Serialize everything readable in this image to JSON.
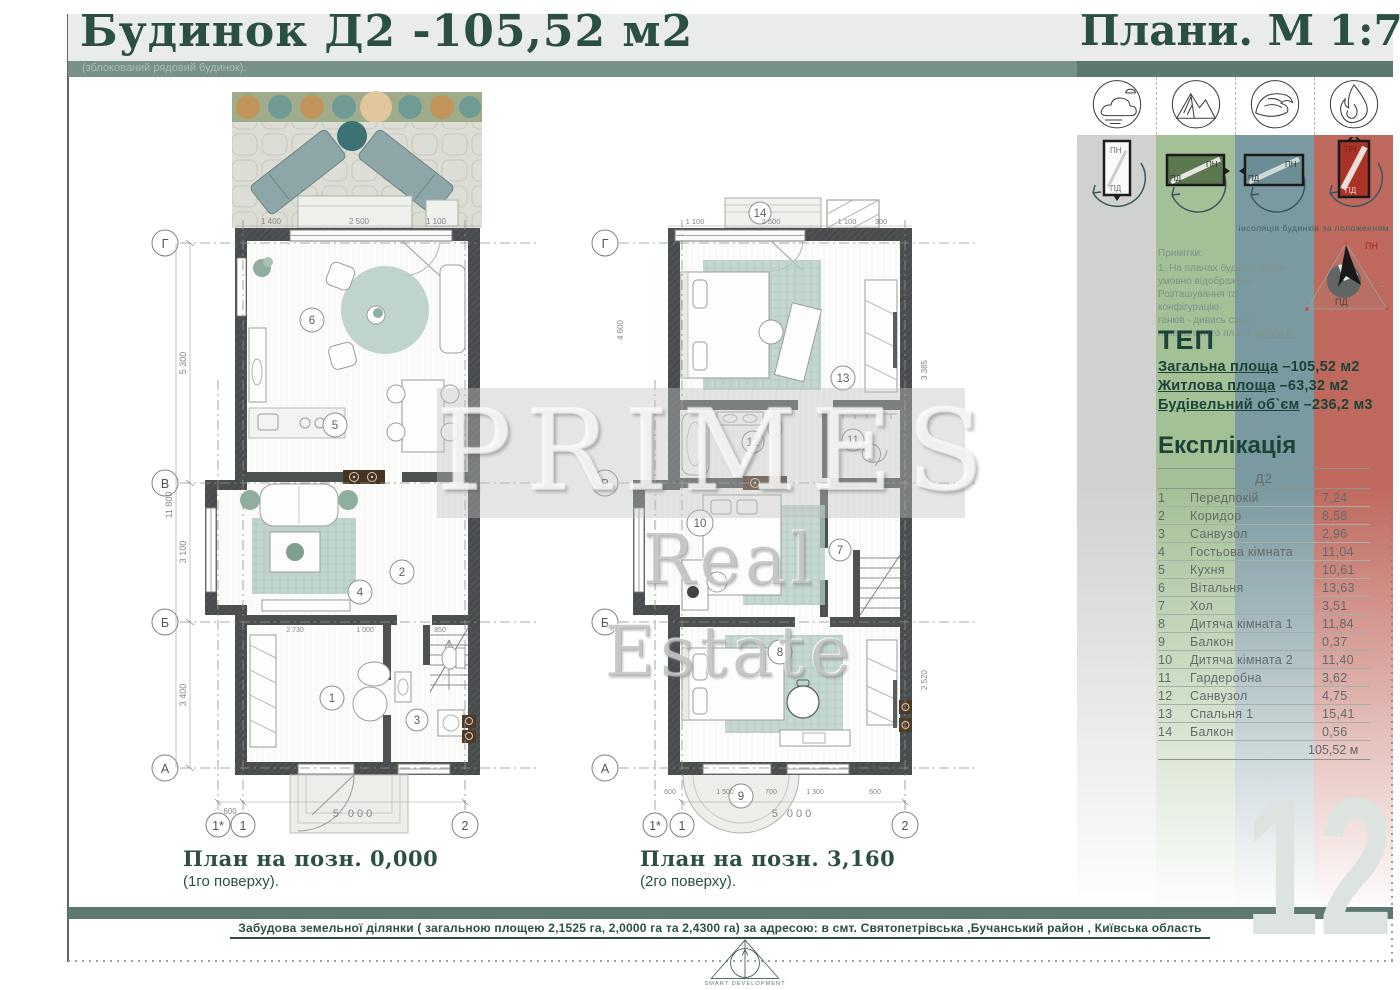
{
  "header": {
    "title": "Будинок Д2 -105,52 м2",
    "subtitle": "(зблокований рядовий будинок).",
    "scale_label": "Плани. М 1:75"
  },
  "watermark": {
    "brand": "PRIMES",
    "brand_sub": "Real Estate"
  },
  "sidebar": {
    "element_icons": [
      "air-icon",
      "mountains-icon",
      "water-icon",
      "fire-icon"
    ],
    "window_north": "ПН",
    "window_south": "ПД",
    "insolation_caption": "інсоляція будинків за положенням",
    "compass": {
      "north": "ПН",
      "south": "ПД",
      "west": "З",
      "east": "С"
    },
    "notes": {
      "title": "Примітки:",
      "lines": [
        "1. На планах будинку ганки",
        "умовно відображені.",
        "Розташування та конфігурацію",
        "ганків - дивись схему",
        "генерального плану, "
      ],
      "link": "аркуш 5."
    },
    "tep": {
      "title": "ТЕП",
      "items": [
        {
          "label": "Загальна площа",
          "value": " –105,52 м2"
        },
        {
          "label": "Житлова площа",
          "value": " –63,32 м2"
        },
        {
          "label": "Будівельний об`єм",
          "value": "  –236,2 м3"
        }
      ]
    },
    "explication": {
      "title": "Експлікація",
      "column_header": "Д2",
      "rows": [
        {
          "num": "1",
          "name": "Передпокій",
          "area": "7,24"
        },
        {
          "num": "2",
          "name": "Коридор",
          "area": "8,58"
        },
        {
          "num": "3",
          "name": "Санвузол",
          "area": "2,96"
        },
        {
          "num": "4",
          "name": "Гостьова кімната",
          "area": "11,04"
        },
        {
          "num": "5",
          "name": "Кухня",
          "area": "10,61"
        },
        {
          "num": "6",
          "name": "Вітальня",
          "area": "13,63"
        },
        {
          "num": "7",
          "name": "Хол",
          "area": "3,51"
        },
        {
          "num": "8",
          "name": "Дитяча кімната 1",
          "area": "11,84"
        },
        {
          "num": "9",
          "name": "Балкон",
          "area": "0,37"
        },
        {
          "num": "10",
          "name": "Дитяча кімната 2",
          "area": "11,40"
        },
        {
          "num": "11",
          "name": "Гардеробна",
          "area": "3,62"
        },
        {
          "num": "12",
          "name": "Санвузол",
          "area": "4,75"
        },
        {
          "num": "13",
          "name": "Спальня 1",
          "area": "15,41"
        },
        {
          "num": "14",
          "name": "Балкон",
          "area": "0,56"
        }
      ],
      "total": "105,52 м"
    },
    "page_number": "12"
  },
  "plans": {
    "left": {
      "caption": "План на позн. 0,000",
      "caption_sub": "(1го поверху).",
      "axis_rows": [
        "Г",
        "В",
        "Б",
        "А"
      ],
      "axis_cols": [
        "1*",
        "1",
        "2"
      ],
      "rooms": {
        "r1": "1",
        "r2": "2",
        "r3": "3",
        "r4": "4",
        "r5": "5",
        "r6": "6"
      },
      "dims": {
        "top_left": "1 400",
        "top_center": "2 500",
        "top_right": "1 100",
        "v_total": "11 800",
        "v1": "5 300",
        "v2": "3 100",
        "v3": "3 400",
        "bottom_small": "600",
        "bottom_total": "5 000",
        "inner1": "2 730",
        "inner2": "1 000",
        "inner3": "850"
      }
    },
    "right": {
      "caption": "План на позн. 3,160",
      "caption_sub": "(2го поверху).",
      "axis_rows": [
        "Г",
        "В",
        "Б",
        "А"
      ],
      "axis_cols": [
        "1*",
        "1",
        "2"
      ],
      "rooms": {
        "r7": "7",
        "r8": "8",
        "r9": "9",
        "r10": "10",
        "r11": "11",
        "r12": "12",
        "r13": "13",
        "r14": "14"
      },
      "dims": {
        "t1": "1 100",
        "t2": "2 500",
        "t3": "1 100",
        "t4": "300",
        "bottom_total": "5 000",
        "b1": "600",
        "b2": "1 500",
        "b3": "700",
        "b4": "1 300",
        "b5": "600",
        "side1": "3 385",
        "side2": "2 520",
        "side3": "4 600"
      }
    }
  },
  "footer": {
    "site_text": "Забудова земельної ділянки ( загальною площею 2,1525 га, 2,0000 га та 2,4300 га) за адресою: в смт. Святопетрівська ,Бучанський район , Київська область",
    "logo_caption": "SMART DEVELOPMENT"
  }
}
